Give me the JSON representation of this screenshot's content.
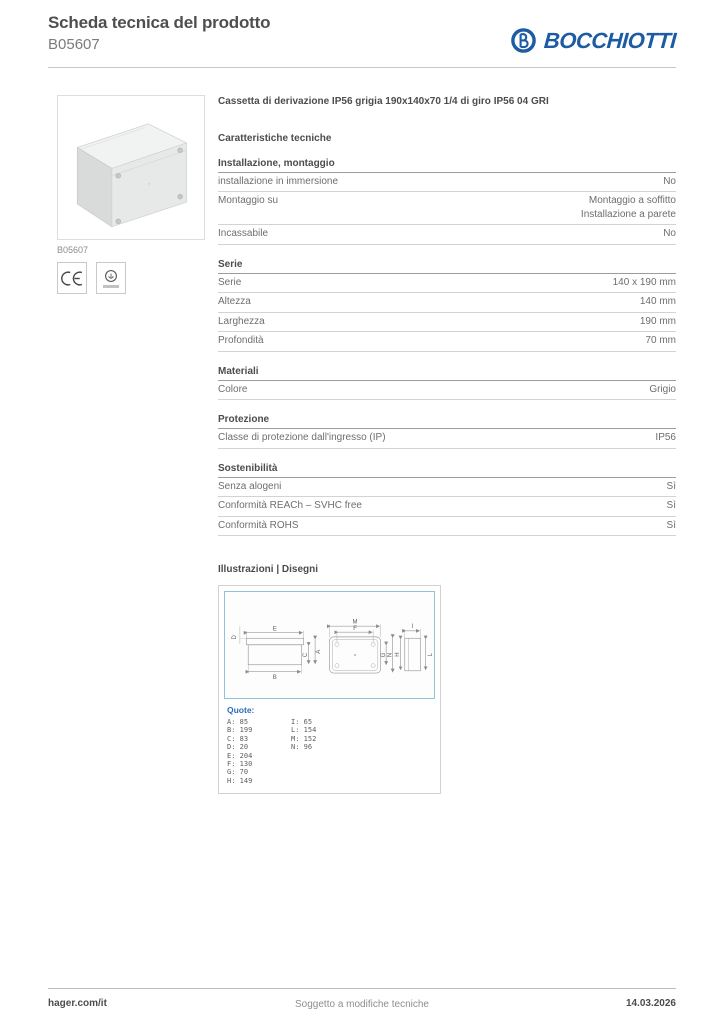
{
  "header": {
    "title": "Scheda tecnica del prodotto",
    "product_code": "B05607",
    "brand": "BOCCHIOTTI"
  },
  "left": {
    "image_caption": "B05607"
  },
  "main": {
    "product_name": "Cassetta di derivazione IP56 grigia 190x140x70 1/4 di giro IP56 04 GRI",
    "characteristics_heading": "Caratteristiche tecniche"
  },
  "characteristics": {
    "sections": [
      {
        "title": "Installazione, montaggio",
        "rows": [
          {
            "label": "installazione in immersione",
            "value": "No"
          },
          {
            "label": "Montaggio su",
            "value": "Montaggio a soffitto",
            "value2": "Installazione a parete"
          },
          {
            "label": "Incassabile",
            "value": "No"
          }
        ]
      },
      {
        "title": "Serie",
        "rows": [
          {
            "label": "Serie",
            "value": "140 x 190 mm"
          },
          {
            "label": "Altezza",
            "value": "140 mm"
          },
          {
            "label": "Larghezza",
            "value": "190 mm"
          },
          {
            "label": "Profondità",
            "value": "70 mm"
          }
        ]
      },
      {
        "title": "Materiali",
        "rows": [
          {
            "label": "Colore",
            "value": "Grigio"
          }
        ]
      },
      {
        "title": "Protezione",
        "rows": [
          {
            "label": "Classe di protezione dall'ingresso (IP)",
            "value": "IP56"
          }
        ]
      },
      {
        "title": "Sostenibilità",
        "rows": [
          {
            "label": "Senza alogeni",
            "value": "Sì"
          },
          {
            "label": "Conformità REACh – SVHC free",
            "value": "Sì"
          },
          {
            "label": "Conformità ROHS",
            "value": "Sì"
          }
        ]
      }
    ]
  },
  "illustrations": {
    "heading": "Illustrazioni | Disegni",
    "quote_label": "Quote:",
    "dimensions_col1": [
      "A: 85",
      "B: 199",
      "C: 83",
      "D: 20",
      "E: 204",
      "F: 130",
      "G: 70",
      "H: 149"
    ],
    "dimensions_col2": [
      "I: 65",
      "L: 154",
      "M: 152",
      "N: 96"
    ],
    "drawing_labels": {
      "D": "D",
      "E": "E",
      "B": "B",
      "C": "C",
      "A": "A",
      "M": "M",
      "F": "F",
      "G": "G",
      "N": "N",
      "I": "I",
      "H": "H",
      "L": "L"
    }
  },
  "footer": {
    "site": "hager.com/it",
    "note": "Soggetto a modifiche tecniche",
    "date": "14.03.2026"
  },
  "colors": {
    "brand_blue": "#1d5ba4",
    "drawing_border_cyan": "#8fc3d9",
    "quote_blue": "#2a6ebb",
    "text_dark": "#4c4c4b",
    "text_gray": "#6e6e6d"
  }
}
